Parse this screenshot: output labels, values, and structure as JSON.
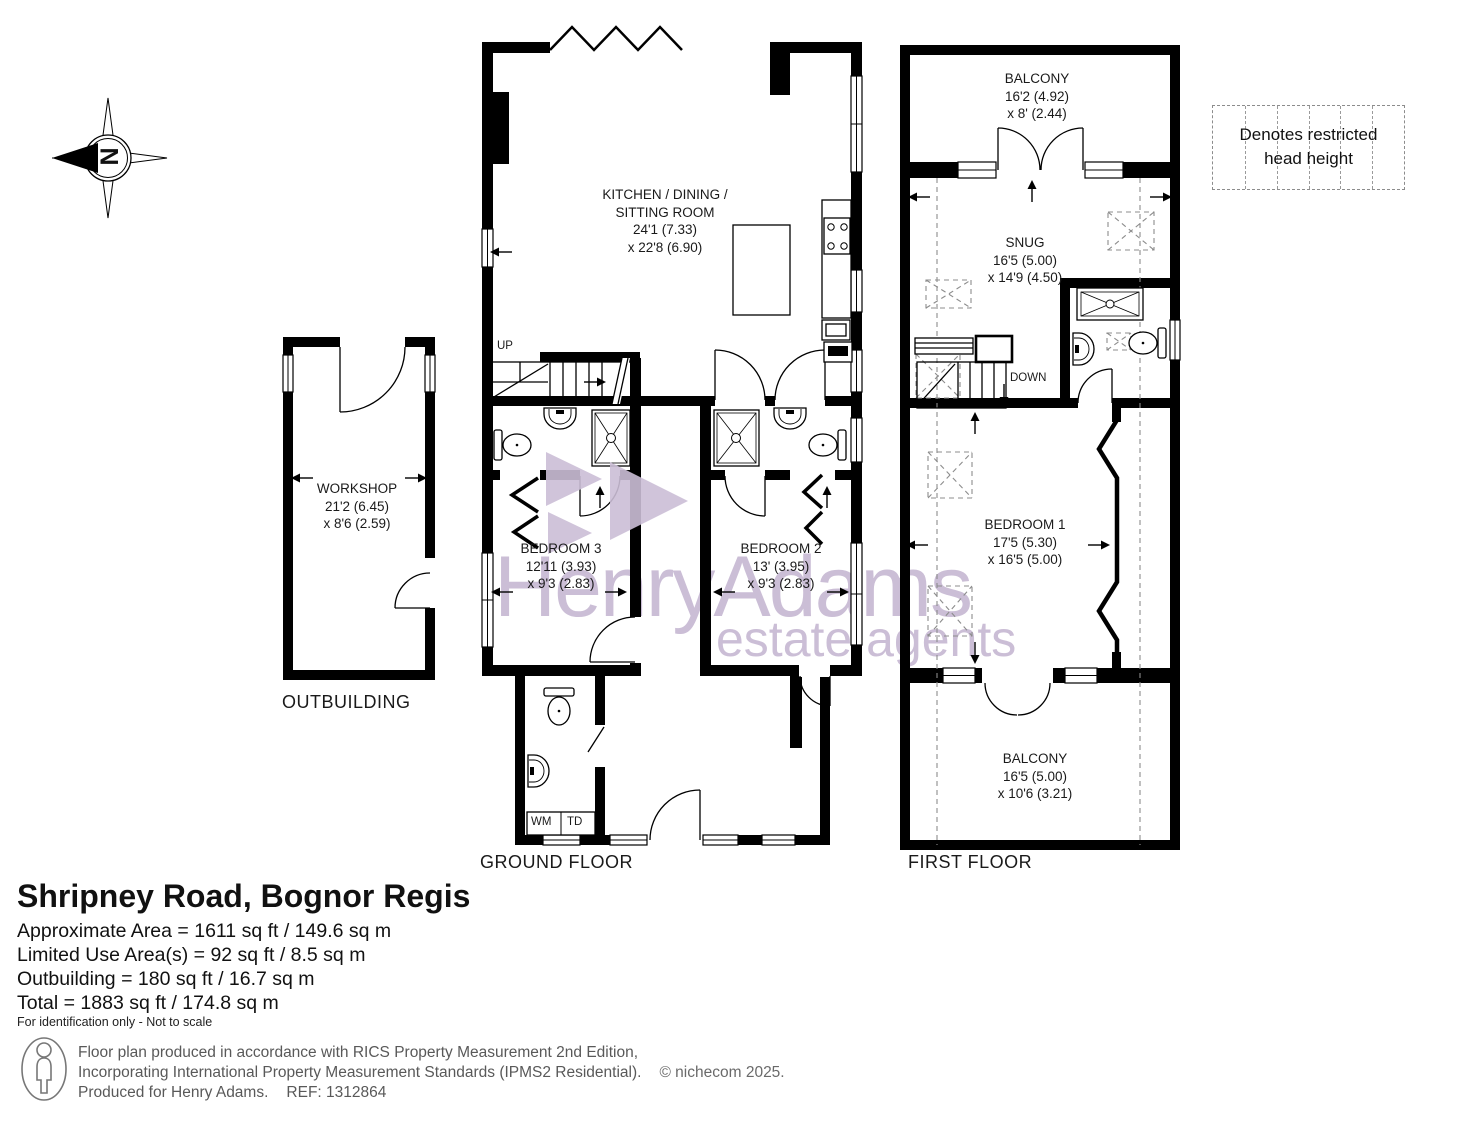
{
  "watermark": {
    "brand": "HenryAdams",
    "tagline": "estate agents"
  },
  "compass": {
    "north_letter": "N"
  },
  "legend": {
    "text": "Denotes restricted head height"
  },
  "floor_labels": {
    "ground": "GROUND FLOOR",
    "first": "FIRST FLOOR",
    "outbuilding": "OUTBUILDING"
  },
  "stair_labels": {
    "up": "UP",
    "down": "DOWN"
  },
  "appliance_labels": {
    "wm": "WM",
    "td": "TD"
  },
  "rooms": {
    "kitchen": {
      "name": "KITCHEN / DINING / SITTING ROOM",
      "dim1": "24'1 (7.33)",
      "dim2": "x 22'8 (6.90)"
    },
    "workshop": {
      "name": "WORKSHOP",
      "dim1": "21'2 (6.45)",
      "dim2": "x 8'6 (2.59)"
    },
    "bedroom3": {
      "name": "BEDROOM 3",
      "dim1": "12'11 (3.93)",
      "dim2": "x 9'3 (2.83)"
    },
    "bedroom2": {
      "name": "BEDROOM 2",
      "dim1": "13' (3.95)",
      "dim2": "x 9'3 (2.83)"
    },
    "bedroom1": {
      "name": "BEDROOM 1",
      "dim1": "17'5 (5.30)",
      "dim2": "x 16'5 (5.00)"
    },
    "snug": {
      "name": "SNUG",
      "dim1": "16'5 (5.00)",
      "dim2": "x 14'9 (4.50)"
    },
    "balcony_front": {
      "name": "BALCONY",
      "dim1": "16'2 (4.92)",
      "dim2": "x 8' (2.44)"
    },
    "balcony_rear": {
      "name": "BALCONY",
      "dim1": "16'5 (5.00)",
      "dim2": "x 10'6 (3.21)"
    }
  },
  "summary": {
    "title": "Shripney Road, Bognor Regis",
    "approximate_area": "Approximate Area = 1611 sq ft / 149.6 sq m",
    "limited_use": "Limited Use Area(s) = 92 sq ft / 8.5 sq m",
    "outbuilding": "Outbuilding = 180 sq ft / 16.7 sq m",
    "total": "Total = 1883 sq ft / 174.8 sq m",
    "disclaimer": "For identification only - Not to scale"
  },
  "footer": {
    "line1": "Floor plan produced in accordance with RICS Property Measurement 2nd Edition,",
    "line2": "Incorporating International Property Measurement Standards (IPMS2 Residential).",
    "copyright": "© nichecom 2025.",
    "line3": "Produced for Henry Adams.",
    "ref": "REF: 1312864"
  },
  "colors": {
    "walls": "#000000",
    "watermark": "#cbbed6",
    "dashed": "#8c8c8c",
    "footer_text": "#595959"
  }
}
